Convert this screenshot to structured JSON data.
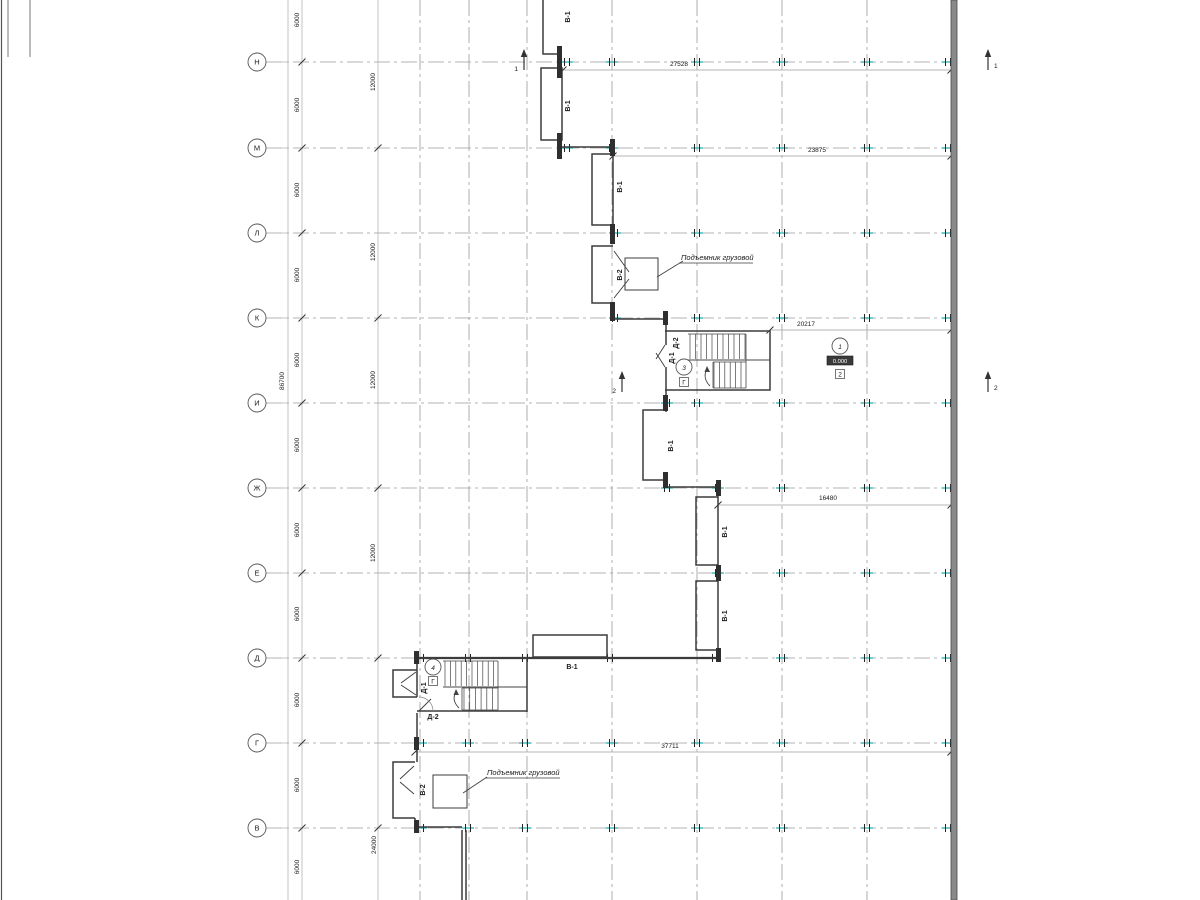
{
  "axes": {
    "rows": [
      {
        "label": "Н"
      },
      {
        "label": "М"
      },
      {
        "label": "Л"
      },
      {
        "label": "К"
      },
      {
        "label": "И"
      },
      {
        "label": "Ж"
      },
      {
        "label": "Е"
      },
      {
        "label": "Д"
      },
      {
        "label": "Г"
      },
      {
        "label": "В"
      }
    ]
  },
  "dims": {
    "total_left": "86700",
    "bay_6000": "6000",
    "bay_12000": "12000",
    "bay_24000": "24000",
    "top_27528": "27528",
    "mid_23875": "23875",
    "mid_20217": "20217",
    "mid_16480": "16480",
    "bottom_37711": "37711"
  },
  "rooms": {
    "stair_v1": "В-1",
    "lift_v2": "В-2",
    "stair_d1": "Д-1",
    "stair_d2": "Д-2"
  },
  "notes": {
    "freight_lift": "Подъемник грузовой",
    "elevation_mark": "0.000"
  },
  "markers": {
    "section_1": "1",
    "section_2": "2",
    "node_3": "3",
    "node_4": "4",
    "node_1": "1",
    "box_g": "Г",
    "box_2": "2"
  },
  "colors": {
    "grid": "#9a9a9a",
    "wall": "#3c3c3c",
    "tick_accent": "#2bb3b3",
    "dim_line": "#b4b4b4",
    "text": "#1a1a1a"
  }
}
